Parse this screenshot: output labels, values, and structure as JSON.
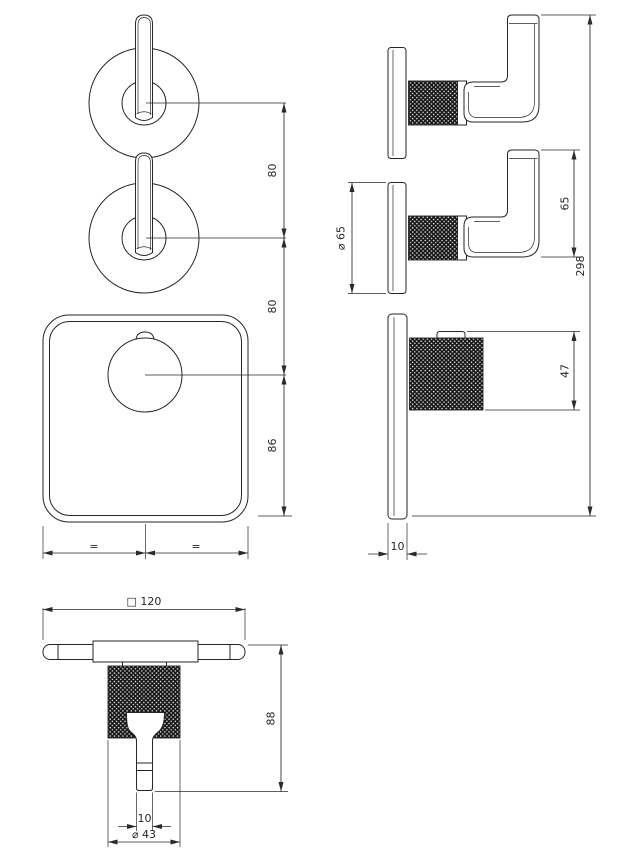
{
  "meta": {
    "canvas_width": "622",
    "canvas_height": "856"
  },
  "colors": {
    "bg": "#ffffff",
    "line": "#262626",
    "dim": "#2a2a2a",
    "knurl": "#1a1a1a"
  },
  "dims": {
    "front": {
      "knob_spacing_upper": "80",
      "knob_spacing_lower": "80",
      "knob_to_plate_bottom": "86",
      "equal_left": "=",
      "equal_right": "="
    },
    "side": {
      "escutcheon_diameter": "⌀ 65",
      "handle_height": "65",
      "overall_height": "298",
      "knob_projection": "47",
      "plate_thickness": "10"
    },
    "bottom": {
      "plate_square": "□ 120",
      "overall_projection": "88",
      "stem_width": "10",
      "knob_diameter": "⌀ 43"
    }
  }
}
